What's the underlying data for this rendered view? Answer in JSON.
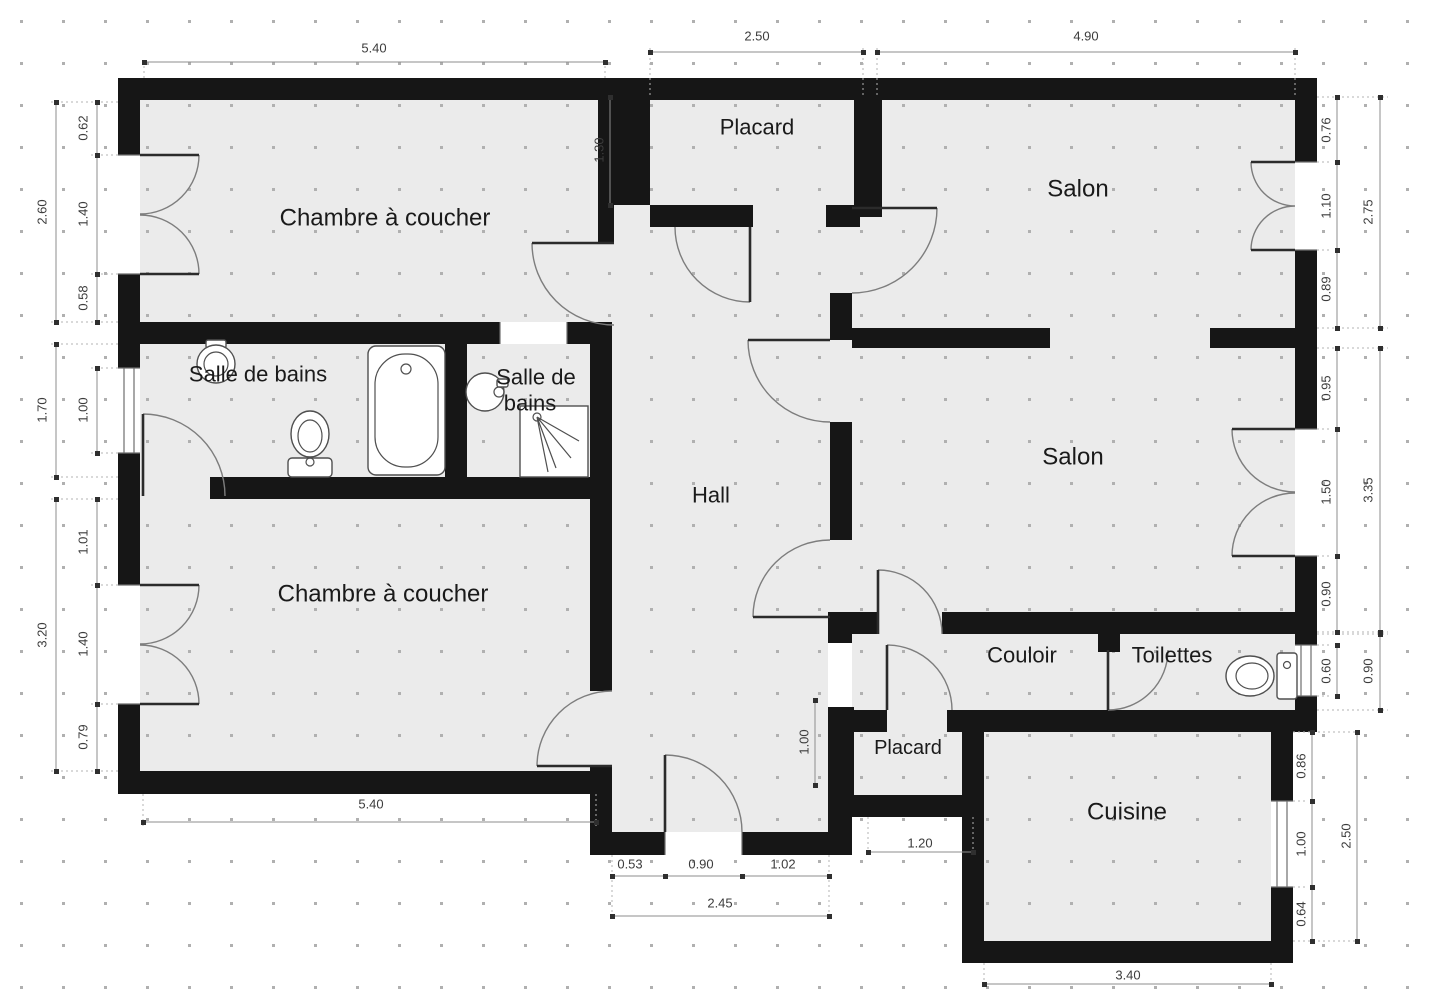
{
  "plan": {
    "type": "apartment-floor-plan",
    "language": "fr",
    "colors": {
      "wall": "#161616",
      "floor": "#ebebeb",
      "background": "#ffffff",
      "dimension_text": "#3c3c3c",
      "dimension_line": "#8e8e8e",
      "grid_dot": "#b0b0b0"
    }
  },
  "rooms": {
    "bedroom_top": "Chambre à coucher",
    "bedroom_bottom": "Chambre à coucher",
    "bathroom_main": "Salle de bains",
    "bathroom_small_line1": "Salle de",
    "bathroom_small_line2": "bains",
    "hall": "Hall",
    "closet_top": "Placard",
    "closet_bottom": "Placard",
    "living_top": "Salon",
    "living_main": "Salon",
    "corridor": "Couloir",
    "wc": "Toilettes",
    "kitchen": "Cuisine"
  },
  "dims": {
    "top_bedroom": "5.40",
    "top_closet": "2.50",
    "top_living": "4.90",
    "left_bedroom_total": "2.60",
    "left_bedroom_a": "0.62",
    "left_bedroom_b": "1.40",
    "left_bedroom_c": "0.58",
    "left_bath_total": "1.70",
    "left_bath_window": "1.00",
    "left_bedroom2_total": "3.20",
    "left_bedroom2_a": "1.01",
    "left_bedroom2_b": "1.40",
    "left_bedroom2_c": "0.79",
    "inner_gap_top": "1.30",
    "right_living_a": "0.76",
    "right_living_b": "1.10",
    "right_living_c": "0.89",
    "right_living_total": "2.75",
    "right_salon_a": "0.95",
    "right_salon_b": "1.50",
    "right_salon_c": "0.90",
    "right_salon_total": "3.35",
    "right_wc_window": "0.60",
    "right_wc_total": "0.90",
    "right_kitchen_a": "0.86",
    "right_kitchen_b": "1.00",
    "right_kitchen_c": "0.64",
    "right_kitchen_total": "2.50",
    "bottom_bedroom2": "5.40",
    "bottom_entry_a": "0.53",
    "bottom_entry_b": "0.90",
    "bottom_entry_c": "1.02",
    "bottom_entry_total": "2.45",
    "hall_inner": "1.00",
    "closet_bottom_width": "1.20",
    "bottom_kitchen": "3.40"
  },
  "fixtures": [
    "sink-main-bathroom",
    "toilet-main-bathroom",
    "bathtub",
    "sink-small-bathroom",
    "shower",
    "toilet-wc"
  ]
}
